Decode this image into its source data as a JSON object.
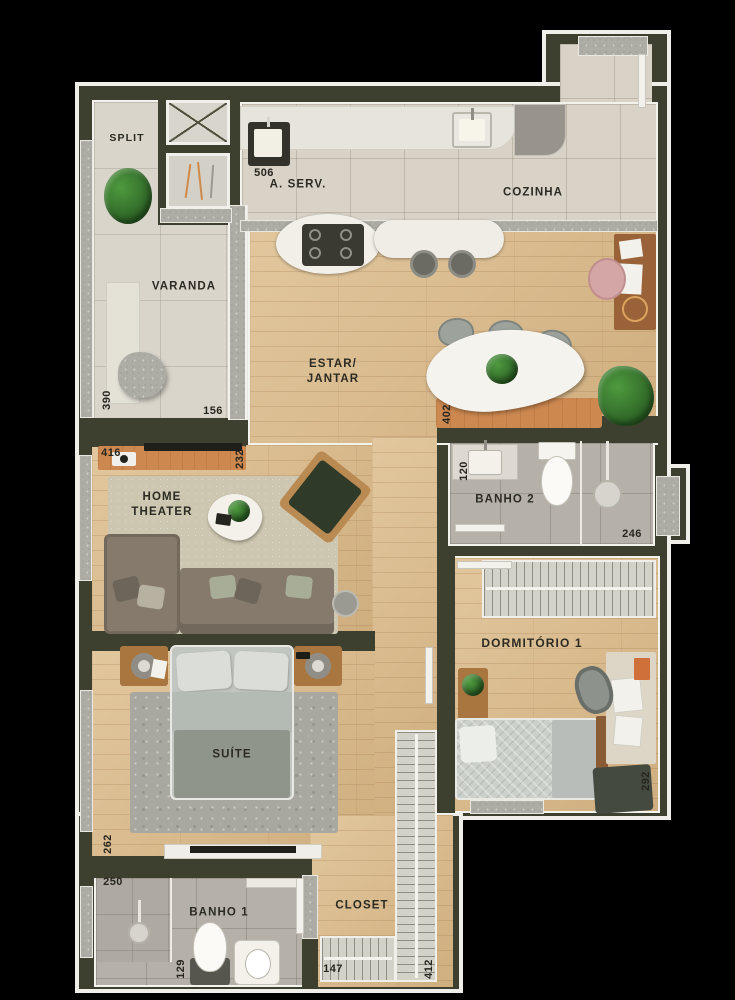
{
  "plan_title": "apartment-floor-plan-top-view",
  "palette": {
    "wall": "#3e402f",
    "outline": "#efeee8",
    "wood_floor": "#d9ba8e",
    "tile_floor": "#d8d2c7",
    "bath_floor": "#b5b1a9",
    "accent_orange": "#cd8850",
    "label_ink": "#2b2b23"
  },
  "rooms": {
    "split": {
      "label": "SPLIT"
    },
    "area_servico": {
      "label": "A. SERV."
    },
    "cozinha": {
      "label": "COZINHA"
    },
    "varanda": {
      "label": "VARANDA"
    },
    "estar_jantar": {
      "label": "ESTAR/\nJANTAR"
    },
    "home_theater": {
      "label": "HOME\nTHEATER"
    },
    "banho2": {
      "label": "BANHO 2"
    },
    "dormitorio1": {
      "label": "DORMITÓRIO 1"
    },
    "suite": {
      "label": "SUÍTE"
    },
    "banho1": {
      "label": "BANHO 1"
    },
    "closet": {
      "label": "CLOSET"
    }
  },
  "dimensions": {
    "tanque": "506",
    "varanda_depth": "390",
    "varanda_width": "156",
    "home_theater_width": "416",
    "home_theater_depth": "232",
    "jantar_sideboard": "402",
    "banho2_width": "120",
    "banho2_length": "246",
    "dormitorio1_depth": "292",
    "suite_depth": "262",
    "banho1_length": "250",
    "banho1_width": "129",
    "closet_rack": "147",
    "closet_length": "412"
  }
}
